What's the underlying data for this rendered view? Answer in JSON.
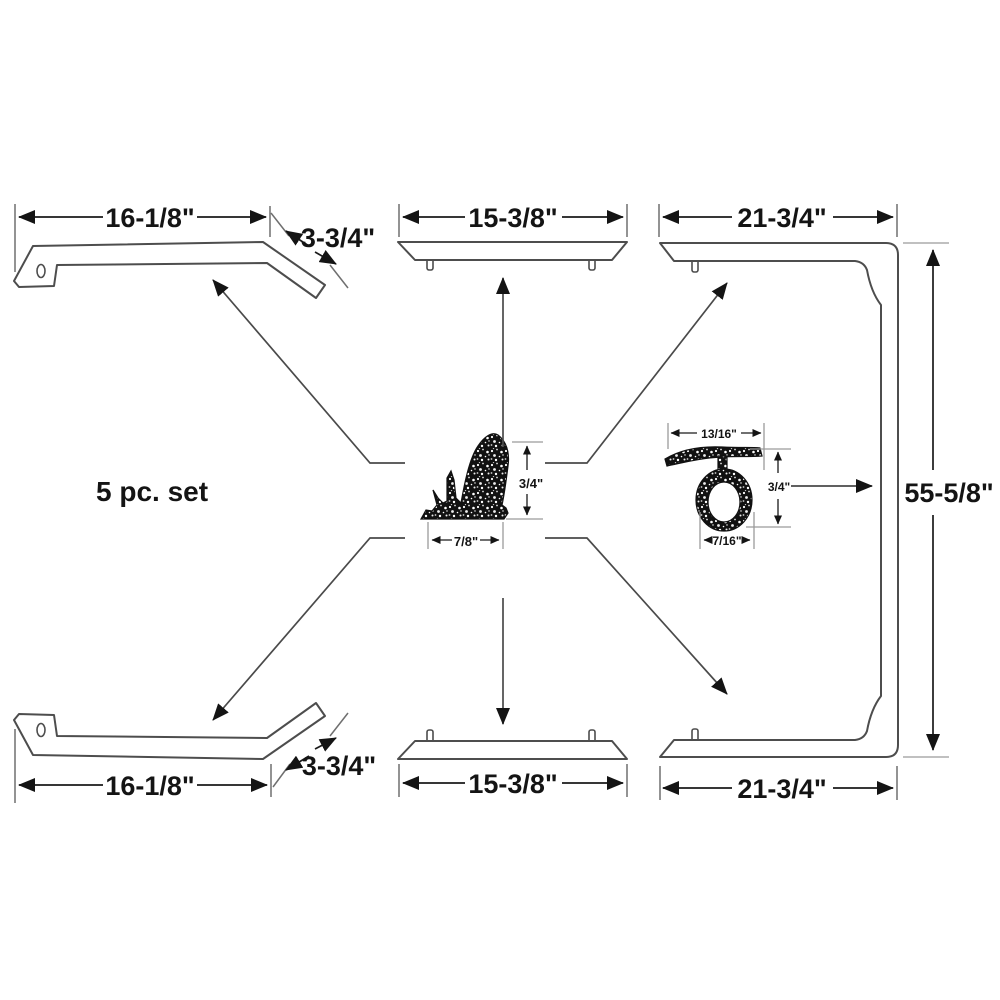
{
  "set_label": "5 pc. set",
  "pieces": {
    "top_left_rail": {
      "length": "16-1/8\"",
      "end_length": "3-3/4\""
    },
    "top_center_strip": {
      "length": "15-3/8\""
    },
    "right_frame": {
      "top_length": "21-3/4\"",
      "height": "55-5/8\"",
      "bottom_length": "21-3/4\""
    },
    "bottom_left_rail": {
      "length": "16-1/8\"",
      "end_length": "3-3/4\""
    },
    "bottom_center_strip": {
      "length": "15-3/8\""
    }
  },
  "profiles": {
    "fin_cross_section": {
      "height": "3/4\"",
      "width": "7/8\""
    },
    "ring_cross_section": {
      "top_width": "13/16\"",
      "height": "3/4\"",
      "bottom_width": "7/16\""
    }
  },
  "colors": {
    "line": "#4d4d4d",
    "dimension": "#1a1a1a",
    "extension": "#9a9a9a",
    "rubber": "#111111",
    "background": "#ffffff"
  }
}
